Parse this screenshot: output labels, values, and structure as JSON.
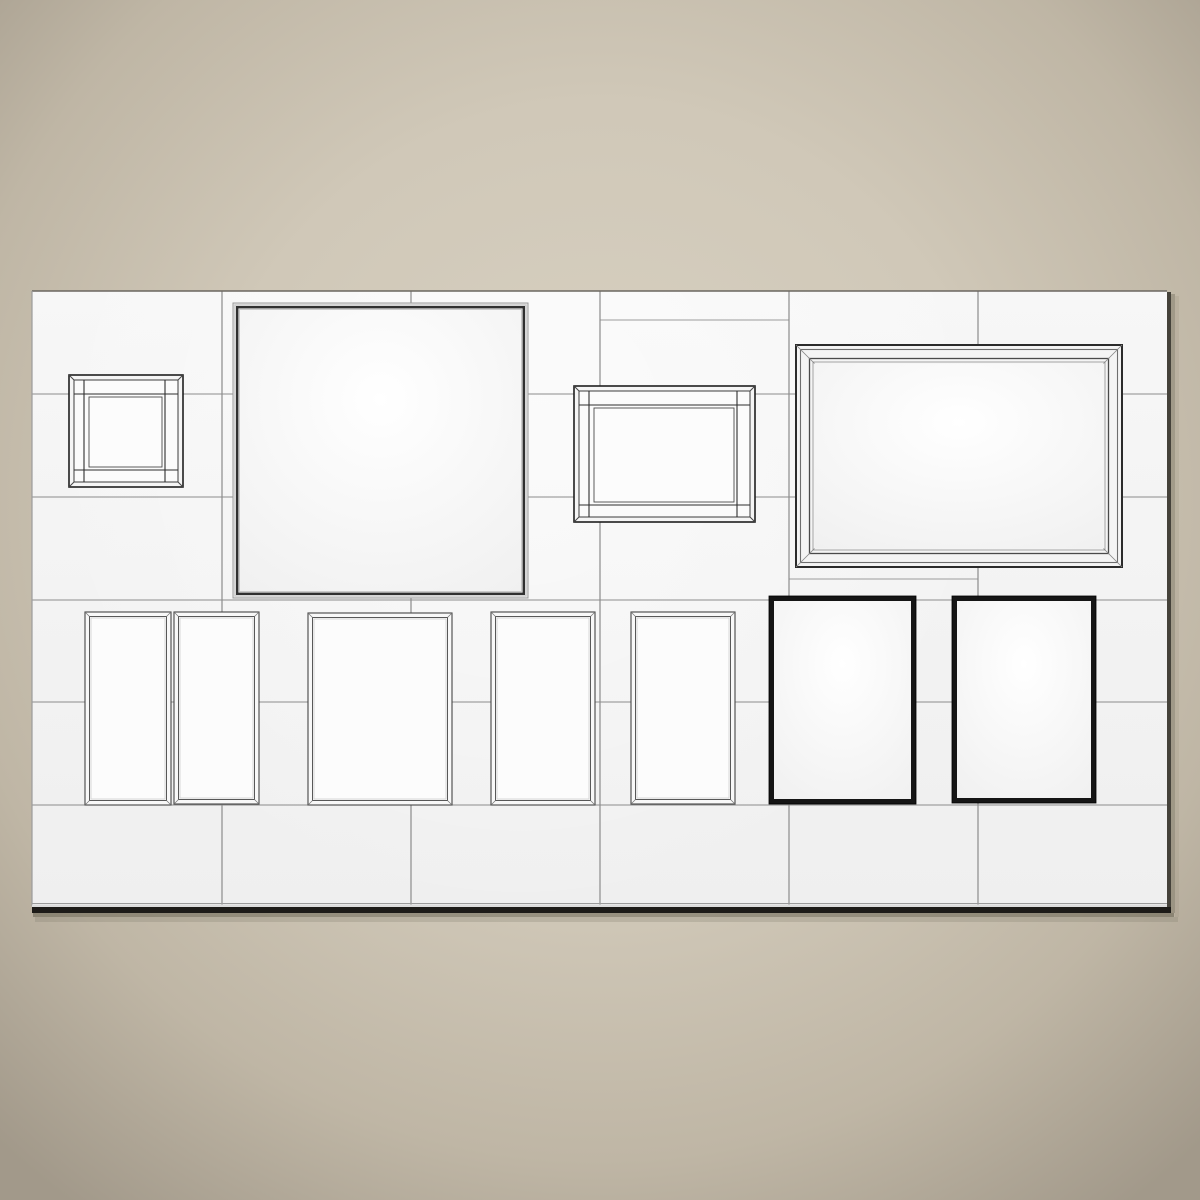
{
  "image": {
    "type": "3d-render-preview",
    "subject": "eleven empty picture frames of mixed styles mounted on a white tiled wall panel over a beige studio backdrop",
    "width_px": 1200,
    "height_px": 1200
  },
  "palette": {
    "bg_center": "#d8d1c2",
    "bg_mid": "#d0c8b8",
    "bg_outer": "#bfb6a5",
    "bg_corner": "#a2998a",
    "wall_fill_top": "#f7f7f7",
    "wall_fill_bottom": "#efefef",
    "grid_line": "#8c8c8c",
    "wall_top_edge": "#6b6760",
    "wall_left_edge": "#9b9b9b",
    "wall_bottom_hairline": "#9a9a9a",
    "wall_bottom_light": "#dcdcdc",
    "wall_shadow_dark": "#1d1b18",
    "wall_shadow_mid": "#55503f",
    "wall_shadow_soft": "#7d7666",
    "frame_outline_dark": "#1f1f1f",
    "frame_outline_mid": "#4a4a4a",
    "frame_outline_soft": "#9b9b9b",
    "frame_black": "#151515",
    "frame_face_light": "#f8f8f8",
    "canvas_white": "#ffffff",
    "canvas_edge": "#f0f0f0"
  },
  "wall": {
    "x": 32,
    "y": 291,
    "w": 1135,
    "h": 615,
    "grid_vertical_x": [
      222,
      411,
      600,
      789,
      978
    ],
    "grid_horizontal_y": [
      394,
      497,
      600,
      702,
      805
    ],
    "extra_joints": [
      {
        "x1": 600,
        "x2": 789,
        "y": 320
      },
      {
        "x1": 789,
        "x2": 978,
        "y": 579
      }
    ]
  },
  "frames": [
    {
      "id": "small-square-shadowbox",
      "style": "shadowbox",
      "x": 69,
      "y": 375,
      "w": 114,
      "h": 112
    },
    {
      "id": "large-square-thin-frame",
      "style": "thin-dark",
      "x": 233,
      "y": 303,
      "w": 295,
      "h": 295
    },
    {
      "id": "landscape-shadowbox",
      "style": "shadowbox",
      "x": 574,
      "y": 386,
      "w": 181,
      "h": 136
    },
    {
      "id": "large-landscape-bevel",
      "style": "wide-bevel",
      "x": 796,
      "y": 345,
      "w": 326,
      "h": 222
    },
    {
      "id": "slim-portrait-1",
      "style": "thin-light",
      "x": 85,
      "y": 612,
      "w": 86,
      "h": 193
    },
    {
      "id": "slim-portrait-2",
      "style": "thin-light",
      "x": 174,
      "y": 612,
      "w": 85,
      "h": 192
    },
    {
      "id": "portrait-3",
      "style": "thin-light",
      "x": 308,
      "y": 613,
      "w": 144,
      "h": 192
    },
    {
      "id": "portrait-4",
      "style": "thin-light",
      "x": 491,
      "y": 612,
      "w": 104,
      "h": 193
    },
    {
      "id": "portrait-5",
      "style": "thin-light",
      "x": 631,
      "y": 612,
      "w": 104,
      "h": 192
    },
    {
      "id": "black-portrait-1",
      "style": "bold-black",
      "x": 769,
      "y": 596,
      "w": 147,
      "h": 208
    },
    {
      "id": "black-portrait-2",
      "style": "bold-black",
      "x": 952,
      "y": 596,
      "w": 144,
      "h": 207
    }
  ]
}
